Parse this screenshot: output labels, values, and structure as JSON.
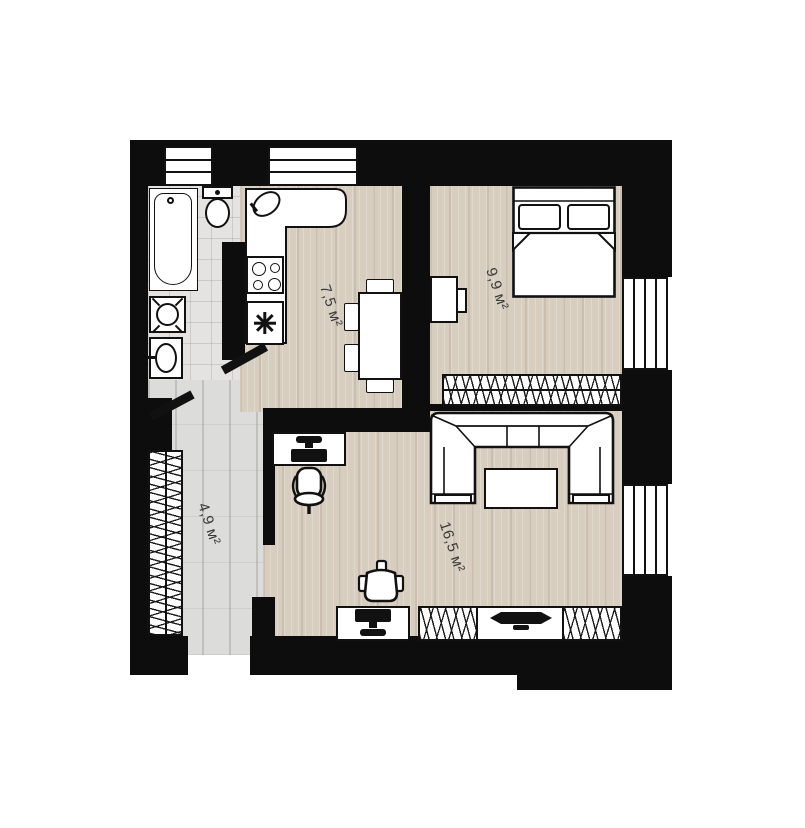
{
  "floorplan": {
    "rooms": [
      {
        "name": "kitchen",
        "area_label": "7,5 м²"
      },
      {
        "name": "bedroom",
        "area_label": "9,9 м²"
      },
      {
        "name": "living-room",
        "area_label": "16,5 м²"
      },
      {
        "name": "hallway",
        "area_label": "4,9 м²"
      }
    ],
    "colors": {
      "walls": "#0d0d0d",
      "wood_floor": "#d8cec0",
      "hallway_floor": "#dcdcda",
      "bathroom_tile": "#e4e3e1",
      "fixture_outline": "#111111",
      "background": "#ffffff",
      "label_text": "#3a3a3a"
    },
    "fixtures": [
      "bathtub",
      "toilet",
      "washing-machine",
      "bathroom-sink",
      "kitchen-counter",
      "kitchen-sink",
      "stove",
      "appliance-star",
      "dining-table",
      "double-bed",
      "tv-console-bedroom",
      "wardrobe-bedroom",
      "wardrobe-hallway",
      "corner-sofa",
      "coffee-table",
      "desk",
      "office-chair",
      "armchair",
      "tv-stand",
      "tv"
    ]
  }
}
